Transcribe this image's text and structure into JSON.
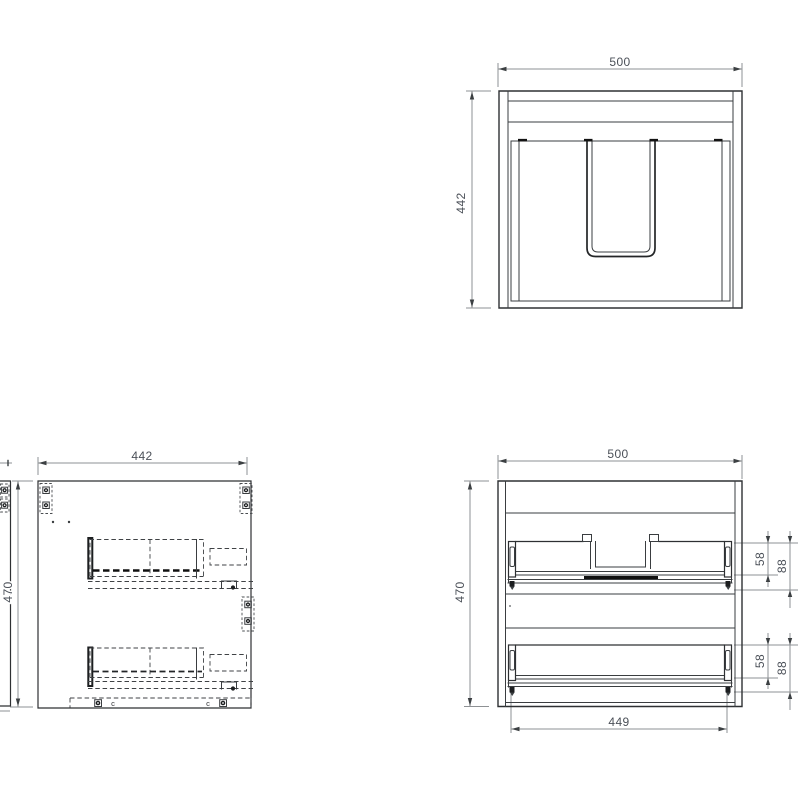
{
  "drawing": {
    "background": "#ffffff",
    "line_color": "#2e3033",
    "dim_line_color": "#8e9194",
    "dim_text_color": "#4b5058",
    "views": {
      "top_view": {
        "label_width": "500",
        "label_depth": "442"
      },
      "side_view": {
        "label_depth": "442",
        "label_height": "470",
        "bottom_fitting_marks": [
          "c",
          "c"
        ]
      },
      "front_view": {
        "label_width": "500",
        "label_height": "470",
        "label_inner_width": "449",
        "upper_drawer": {
          "label_front_height": "58",
          "label_total_height": "88"
        },
        "lower_drawer": {
          "label_front_height": "58",
          "label_total_height": "88"
        }
      }
    }
  }
}
